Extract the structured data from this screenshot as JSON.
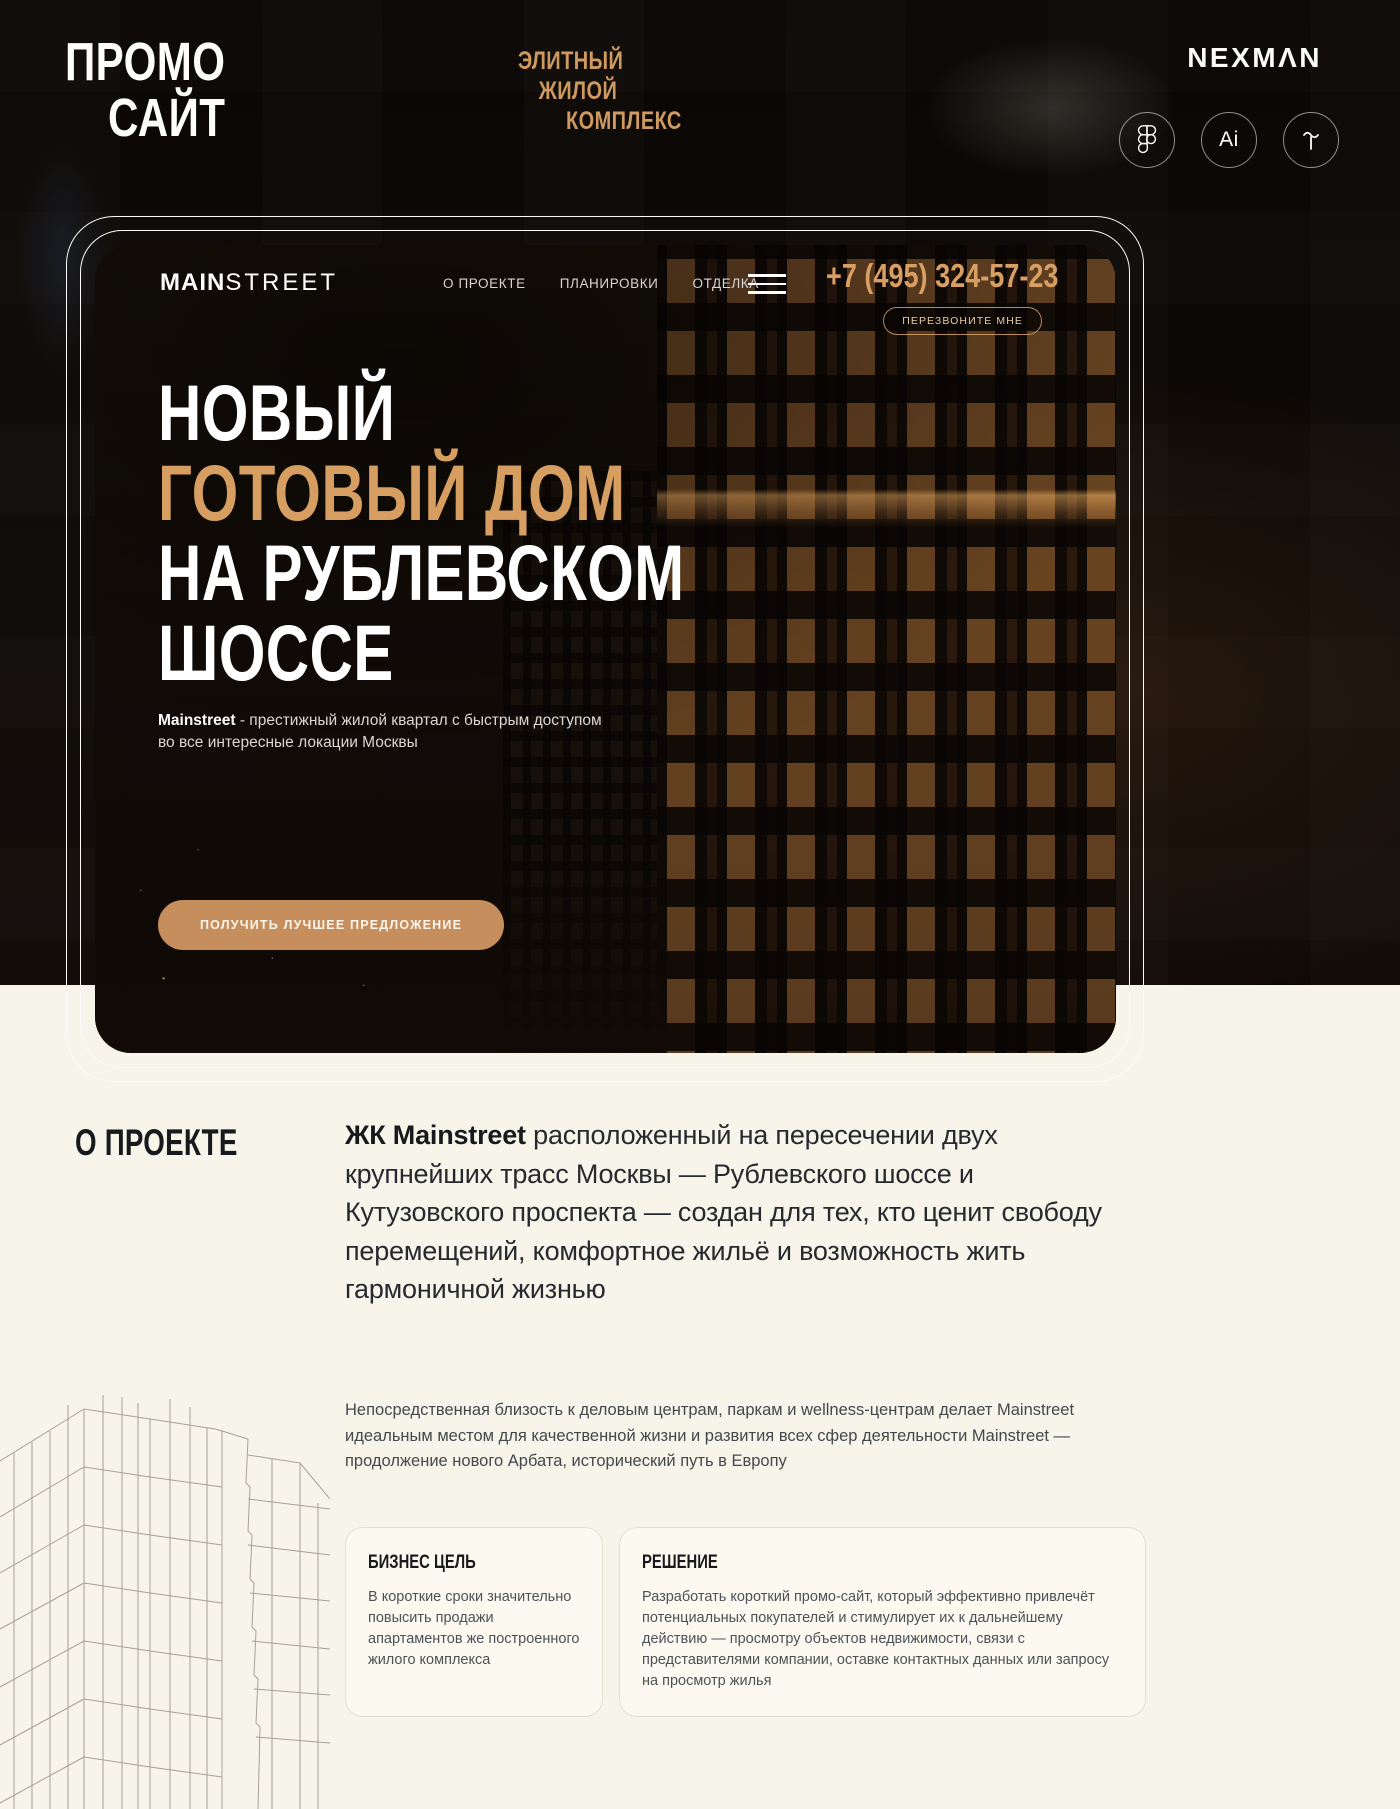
{
  "colors": {
    "accent_gold": "#cf9a5f",
    "headline_gold": "#d69e60",
    "cta_bg": "#c68e5c",
    "page_cream": "#f7f4ea",
    "dark": "#0d0906"
  },
  "header": {
    "title_line1": "ПРОМО",
    "title_line2": "САЙТ",
    "subtitle_lines": [
      "ЭЛИТНЫЙ",
      "ЖИЛОЙ",
      "КОМПЛЕКС"
    ],
    "brand": "NEXMΛN",
    "tools": [
      {
        "icon": "figma-icon"
      },
      {
        "icon": "adobe-illustrator-icon",
        "label": "Ai"
      },
      {
        "icon": "tilda-icon"
      }
    ]
  },
  "site": {
    "logo_bold": "MAIN",
    "logo_light": "STREET",
    "nav": [
      "О ПРОЕКТЕ",
      "ПЛАНИРОВКИ",
      "ОТДЕЛКА"
    ],
    "phone": "+7 (495) 324-57-23",
    "callback_label": "ПЕРЕЗВОНИТЕ МНЕ",
    "hero": {
      "line1": "НОВЫЙ",
      "line2": "ГОТОВЫЙ ДОМ",
      "line3": "НА РУБЛЕВСКОМ",
      "line4": "ШОССЕ",
      "sub_bold": "Mainstreet",
      "sub_rest": " - престижный жилой квартал с быстрым доступом во все интересные локации Москвы",
      "cta": "ПОЛУЧИТЬ ЛУЧШЕЕ ПРЕДЛОЖЕНИЕ"
    }
  },
  "about": {
    "heading": "О ПРОЕКТЕ",
    "lead_bold": "ЖК Mainstreet",
    "lead_rest": " расположенный на пересечении двух крупнейших трасс Москвы — Рублевского шоссе и Кутузовского проспекта — создан для тех, кто ценит свободу перемещений, комфортное жильё и возможность жить гармоничной жизнью",
    "paragraph": "Непосредственная близость к деловым центрам, паркам и wellness-центрам делает Mainstreet идеальным местом для качественной жизни и развития всех сфер деятельности Mainstreet — продолжение нового Арбата, исторический путь в Европу",
    "cards": [
      {
        "title": "БИЗНЕС ЦЕЛЬ",
        "body": "В короткие сроки значительно повысить продажи апартаментов же построенного жилого комплекса"
      },
      {
        "title": "РЕШЕНИЕ",
        "body": "Разработать короткий промо-сайт, который эффективно привлечёт потенциальных покупателей и стимулирует их к дальнейшему действию — просмотру объектов недвижимости, связи с представителями компании, оставке контактных данных или запросу на просмотр жилья"
      }
    ]
  }
}
